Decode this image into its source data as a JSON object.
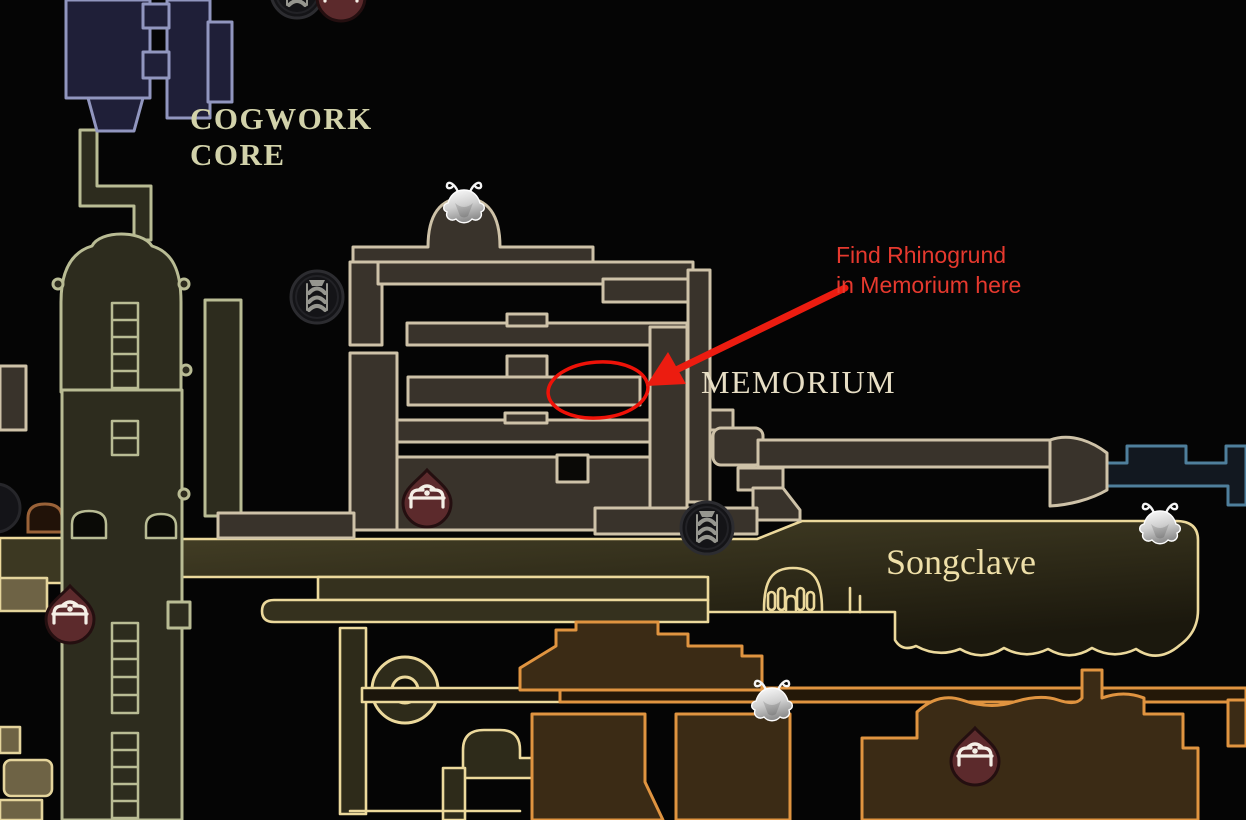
{
  "map": {
    "regions": [
      {
        "id": "cogwork-core",
        "label_line1": "COGWORK",
        "label_line2": "CORE"
      },
      {
        "id": "memorium",
        "label": "MEMORIUM"
      },
      {
        "id": "songclave",
        "label": "Songclave"
      }
    ],
    "labels": {
      "cogwork_line1": "COGWORK",
      "cogwork_line2": "CORE",
      "memorium": "MEMORIUM",
      "songclave": "Songclave"
    },
    "icons": [
      {
        "name": "bench-icon",
        "meaning": "bench rest point marker",
        "count": 4
      },
      {
        "name": "tube-station-icon",
        "meaning": "tube travel station marker",
        "count": 3
      },
      {
        "name": "bell-flower-icon",
        "meaning": "bellway flower marker",
        "count": 3
      }
    ]
  },
  "annotation": {
    "line1": "Find Rhinogrund",
    "line2": "in Memorium here",
    "text_color": "#e6392e",
    "arrow_color": "#ec1c10",
    "ellipse_color": "#ee1208"
  },
  "colors": {
    "background": "#050505",
    "memorium_outline": "#cec2a8",
    "memorium_fill": "#39332b",
    "cogwork_outline": "#b9bc94",
    "cogwork_fill": "#2d2c1e",
    "songclave_outline": "#ecd99c",
    "orange_outline": "#e09440",
    "blue_corridor_outline": "#4f7f9c",
    "navy_room_outline": "#9196bf",
    "bench_icon_fill": "#5c2a2c",
    "label_color": "#d2d2aa"
  }
}
